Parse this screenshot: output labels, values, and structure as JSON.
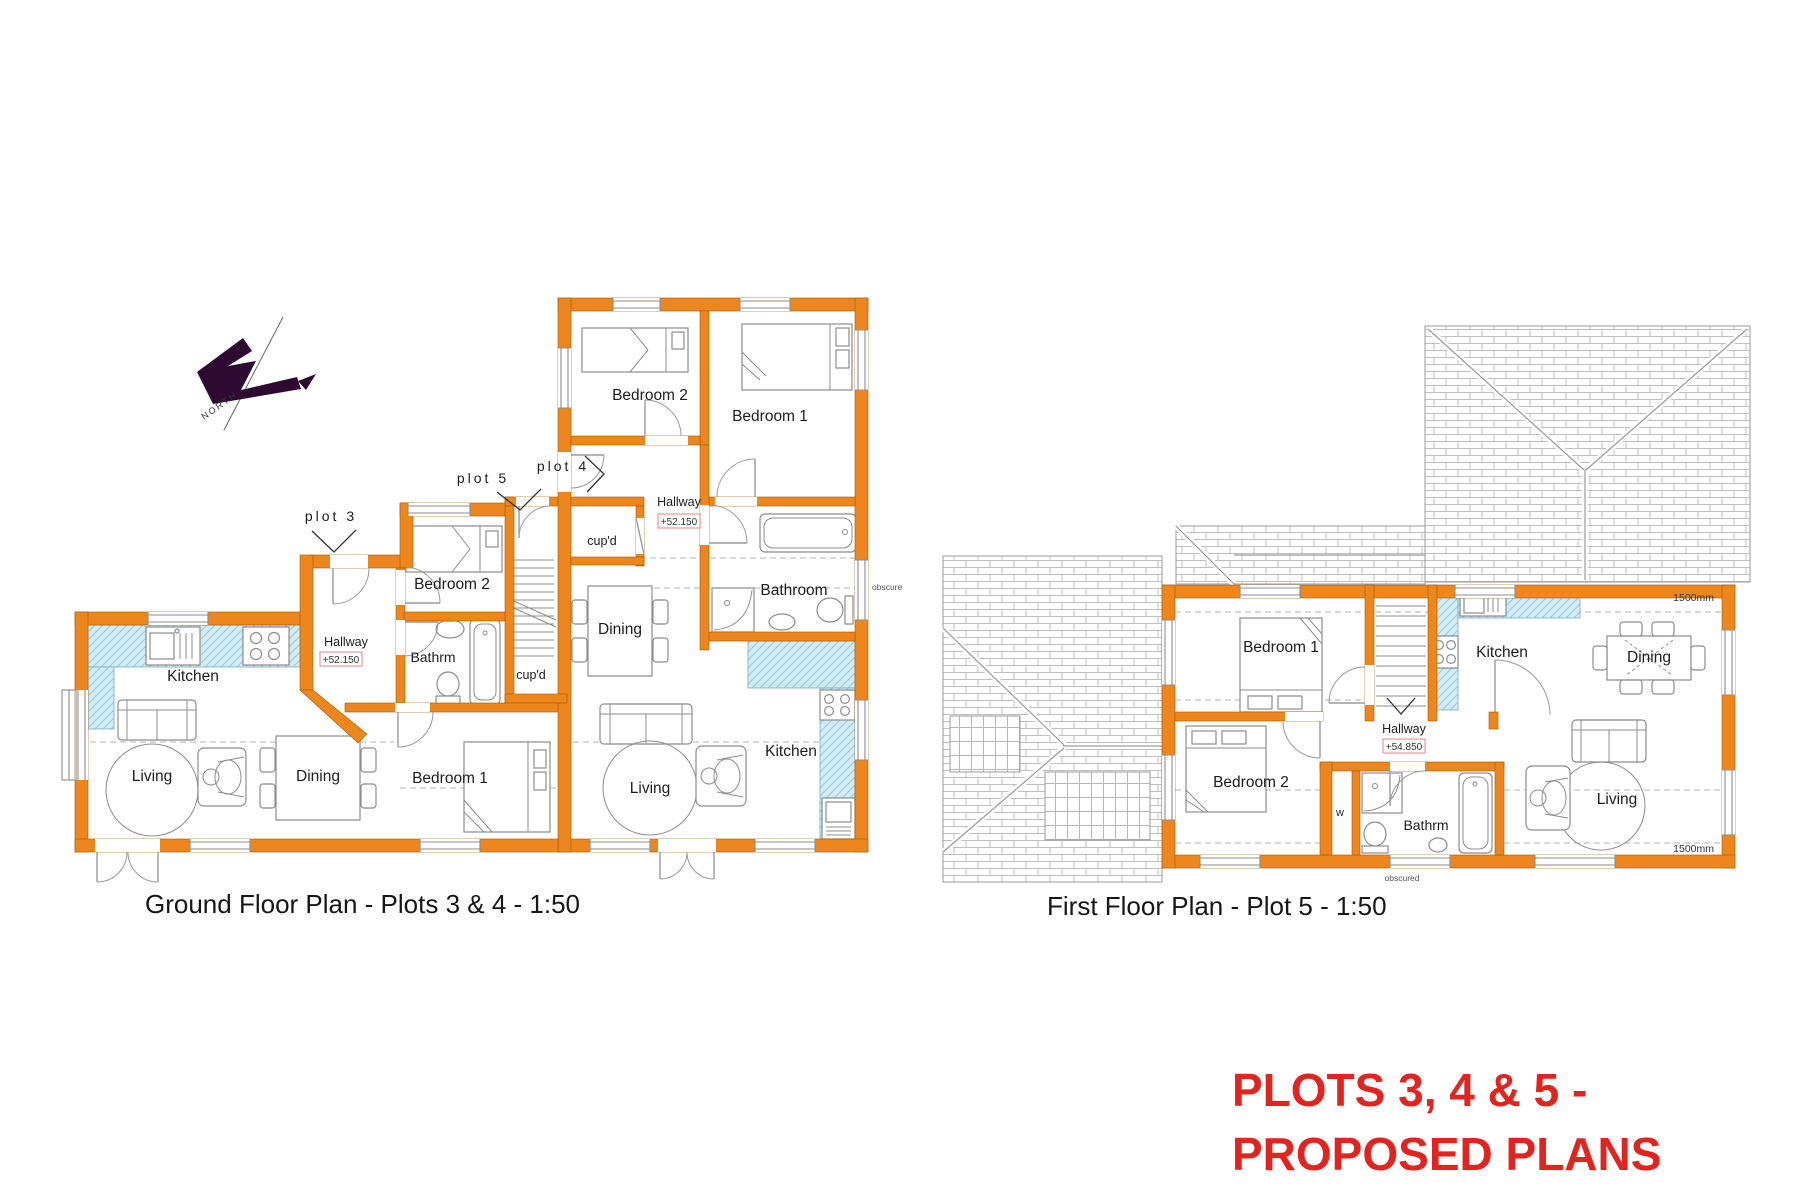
{
  "north": {
    "label": "NORTH"
  },
  "ground_floor": {
    "title": "Ground Floor Plan - Plots 3 & 4 - 1:50",
    "plot3": {
      "label": "plot 3",
      "kitchen": "Kitchen",
      "living": "Living",
      "dining": "Dining",
      "hallway": "Hallway",
      "level": "+52.150",
      "bathroom": "Bathrm",
      "bedroom2": "Bedroom 2",
      "bedroom1": "Bedroom 1"
    },
    "plot5": {
      "label": "plot 5",
      "cupboard": "cup'd"
    },
    "plot4": {
      "label": "plot 4",
      "bedroom2": "Bedroom 2",
      "bedroom1": "Bedroom 1",
      "hallway": "Hallway",
      "level": "+52.150",
      "cupboard": "cup'd",
      "bathroom": "Bathroom",
      "window_note": "obscure",
      "dining": "Dining",
      "living": "Living",
      "kitchen": "Kitchen"
    }
  },
  "first_floor": {
    "title": "First Floor Plan - Plot 5 - 1:50",
    "bedroom1": "Bedroom 1",
    "bedroom2": "Bedroom 2",
    "hallway": "Hallway",
    "level": "+54.850",
    "kitchen": "Kitchen",
    "dining": "Dining",
    "living": "Living",
    "bathroom": "Bathrm",
    "wardrobe": "w",
    "window_note": "obscured",
    "dim_top": "1500mm",
    "dim_bottom": "1500mm"
  },
  "sheet_title": {
    "line1": "PLOTS 3, 4 & 5 -",
    "line2": "PROPOSED PLANS",
    "color": "#E2231E"
  },
  "colors": {
    "wall": "#ED861C",
    "counter_fill": "#CFECF7",
    "counter_hatch": "#9FC6D8",
    "roof_line": "#C0C0C0",
    "level_box_border": "#E89898",
    "north_arrow": "#2E0A33"
  }
}
